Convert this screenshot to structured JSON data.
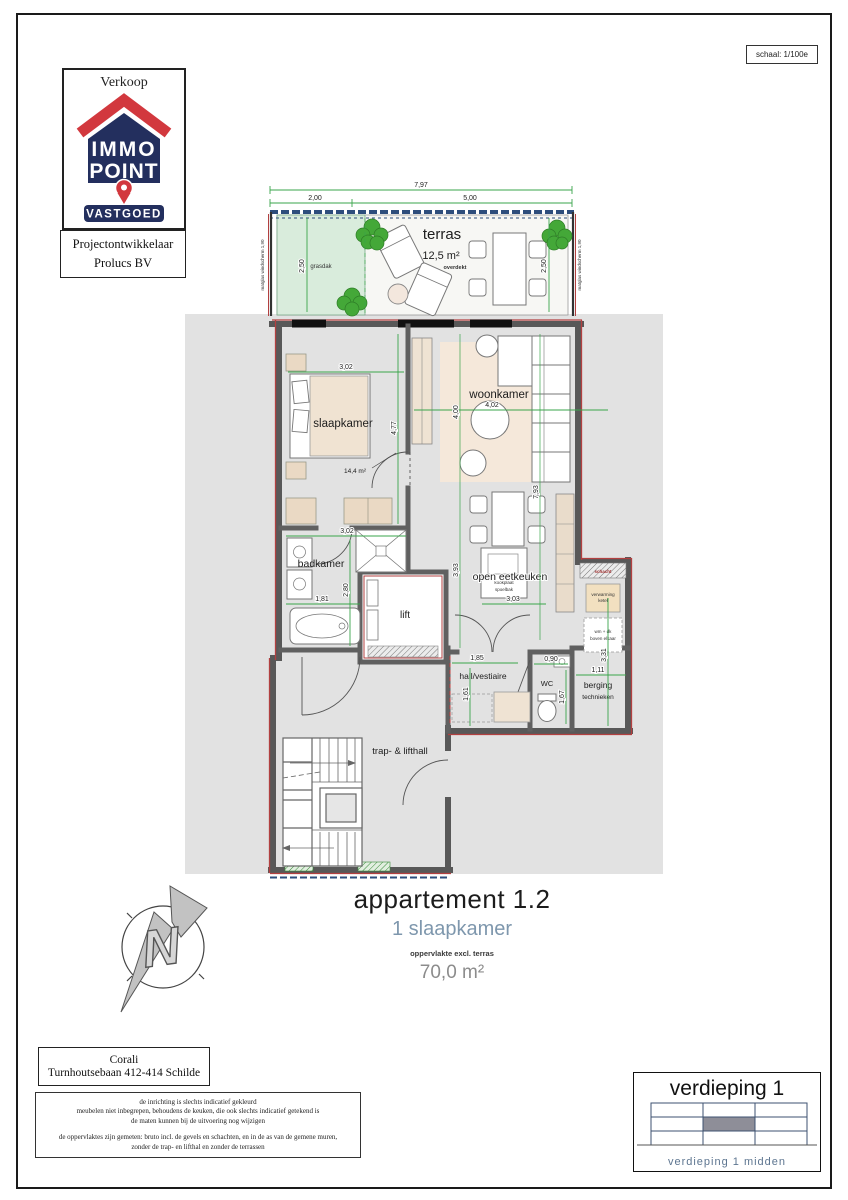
{
  "page": {
    "scale_label": "schaal: 1/100e"
  },
  "logo": {
    "sale_type": "Verkoop",
    "brand_line1": "IMMO",
    "brand_line2": "POINT",
    "brand_sub": "VASTGOED"
  },
  "developer": {
    "line1": "Projectontwikkelaar",
    "line2": "Prolucs BV"
  },
  "plan": {
    "terras": {
      "label": "terras",
      "area": "12,5 m²",
      "note": "overdekt",
      "grasdak": "grasdak",
      "screen_left": "matglas windscherm 1,90",
      "screen_right": "matglas windscherm 1,90"
    },
    "rooms": {
      "slaapkamer": "slaapkamer",
      "slaapkamer_area": "14,4 m²",
      "woonkamer": "woonkamer",
      "badkamer": "badkamer",
      "lift": "lift",
      "eetkeuken": "open eetkeuken",
      "hall": "hall/vestiaire",
      "wc": "WC",
      "berging_1": "berging",
      "berging_2": "technieken",
      "traphall": "trap- & lifthall",
      "schacht": "schacht",
      "tech_1": "verwarming",
      "tech_2": "ketel",
      "wash_1": "wm + dk",
      "wash_2": "boven elkaar",
      "kitchen_1": "kookplaat",
      "kitchen_2": "spoelbak"
    },
    "dims": {
      "terras_total": "7,97",
      "terras_left": "2,00",
      "terras_right": "5,00",
      "terras_depth_left": "2,50",
      "terras_depth_right": "2,50",
      "slaap_w": "3,02",
      "slaap_h": "4,77",
      "woon_w": "4,02",
      "woon_h": "4,00",
      "woon_right": "7,93",
      "bad_w": "3,02",
      "bad_h": "2,80",
      "bad_tub": "1,81",
      "eet_w": "3,03",
      "eet_h": "3,93",
      "hall_w": "1,85",
      "hall_h": "1,61",
      "wc_w": "0,90",
      "wc_h": "1,67",
      "berging_w": "1,11",
      "berging_h": "3,31"
    },
    "north_letter": "N"
  },
  "title_block": {
    "title": "appartement 1.2",
    "subtitle": "1 slaapkamer",
    "area_note": "oppervlakte excl. terras",
    "area": "70,0 m²"
  },
  "address": {
    "line1": "Corali",
    "line2": "Turnhoutsebaan 412-414 Schilde"
  },
  "disclaimer": {
    "lines": [
      "de inrichting is slechts indicatief gekleurd",
      "meubelen niet inbegrepen, behoudens de keuken, die ook slechts indicatief getekend is",
      "de maten kunnen bij de uitvoering nog wijzigen",
      "de oppervlaktes zijn gemeten: bruto incl. de gevels en schachten, en in de as van de gemene muren,",
      "zonder de trap- en lifthal en zonder de terrassen"
    ]
  },
  "floor_indicator": {
    "title": "verdieping 1",
    "caption": "verdieping 1   midden"
  },
  "colors": {
    "dimension_green": "#3aa54b",
    "wall_gray": "#585858",
    "wall_red": "#b24040",
    "brand_navy": "#232f5e",
    "brand_red": "#d2383e",
    "subtitle_blue": "#7e97ad",
    "terrace_green": "#d9ecdc",
    "railing_blue": "#2d4d7c"
  }
}
